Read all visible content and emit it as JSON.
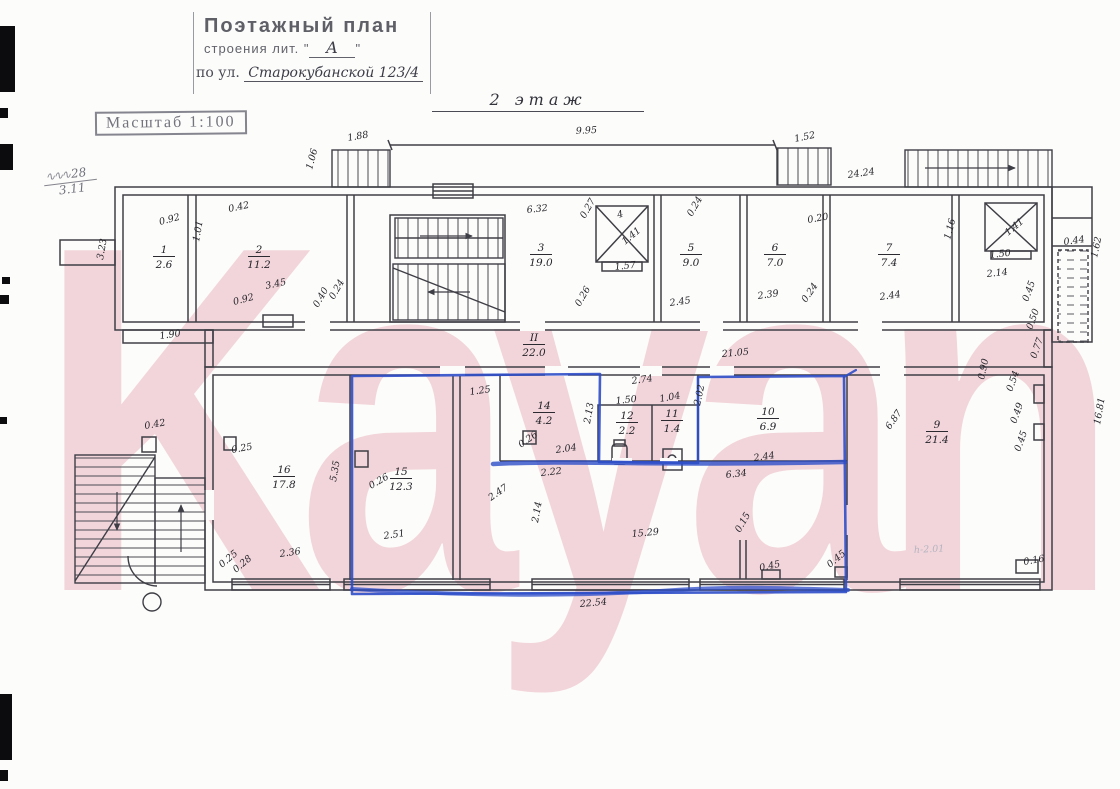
{
  "stamp": {
    "title": "Поэтажный план",
    "line2_prefix": "строения лит. \"",
    "lit": "А",
    "line2_suffix": "\"",
    "line3_prefix": "по ул.",
    "street": "Старокубанской 123/4"
  },
  "scale_stamp": "Масштаб 1:100",
  "floor_title": "2 этаж",
  "margin_note": {
    "top": "28",
    "bottom": "3.11"
  },
  "watermark": {
    "text": "Kayan",
    "color": "#eab6c0"
  },
  "highlight_color": "#2d4ec8",
  "plan": {
    "rooms": [
      {
        "n": "1",
        "a": "2.6",
        "x": 163,
        "y": 253
      },
      {
        "n": "2",
        "a": "11.2",
        "x": 258,
        "y": 253
      },
      {
        "n": "3",
        "a": "19.0",
        "x": 540,
        "y": 251
      },
      {
        "n": "5",
        "a": "9.0",
        "x": 690,
        "y": 251
      },
      {
        "n": "6",
        "a": "7.0",
        "x": 774,
        "y": 251
      },
      {
        "n": "7",
        "a": "7.4",
        "x": 888,
        "y": 251
      },
      {
        "n": "II",
        "a": "22.0",
        "x": 533,
        "y": 341
      },
      {
        "n": "14",
        "a": "4.2",
        "x": 543,
        "y": 409
      },
      {
        "n": "12",
        "a": "2.2",
        "x": 626,
        "y": 419
      },
      {
        "n": "11",
        "a": "1.4",
        "x": 671,
        "y": 417
      },
      {
        "n": "10",
        "a": "6.9",
        "x": 767,
        "y": 415
      },
      {
        "n": "9",
        "a": "21.4",
        "x": 936,
        "y": 428
      },
      {
        "n": "16",
        "a": "17.8",
        "x": 283,
        "y": 473
      },
      {
        "n": "15",
        "a": "12.3",
        "x": 400,
        "y": 475
      }
    ],
    "dim_labels": [
      {
        "t": "1.88",
        "x": 348,
        "y": 141,
        "r": -10
      },
      {
        "t": "9.95",
        "x": 576,
        "y": 134,
        "r": -3
      },
      {
        "t": "1.52",
        "x": 795,
        "y": 142,
        "r": -12
      },
      {
        "t": "1.06",
        "x": 312,
        "y": 170,
        "r": -75
      },
      {
        "t": "24.24",
        "x": 848,
        "y": 178,
        "r": -8
      },
      {
        "t": "3.23",
        "x": 103,
        "y": 260,
        "r": -80
      },
      {
        "t": "1.90",
        "x": 160,
        "y": 339,
        "r": -8
      },
      {
        "t": "0.92",
        "x": 160,
        "y": 225,
        "r": -15
      },
      {
        "t": "1.01",
        "x": 199,
        "y": 242,
        "r": -80
      },
      {
        "t": "0.42",
        "x": 229,
        "y": 212,
        "r": -12
      },
      {
        "t": "0.92",
        "x": 234,
        "y": 305,
        "r": -15
      },
      {
        "t": "3.45",
        "x": 266,
        "y": 289,
        "r": -12
      },
      {
        "t": "0.40",
        "x": 318,
        "y": 308,
        "r": -60
      },
      {
        "t": "0.24",
        "x": 334,
        "y": 300,
        "r": -60
      },
      {
        "t": "6.32",
        "x": 527,
        "y": 213,
        "r": -6
      },
      {
        "t": "0.27",
        "x": 585,
        "y": 219,
        "r": -60
      },
      {
        "t": "0.26",
        "x": 580,
        "y": 307,
        "r": -60
      },
      {
        "t": "4",
        "x": 618,
        "y": 218,
        "r": -15
      },
      {
        "t": "1.41",
        "x": 625,
        "y": 245,
        "r": -40
      },
      {
        "t": "1.57",
        "x": 615,
        "y": 270,
        "r": -6
      },
      {
        "t": "0.24",
        "x": 692,
        "y": 217,
        "r": -60
      },
      {
        "t": "2.45",
        "x": 670,
        "y": 306,
        "r": -8
      },
      {
        "t": "0.20",
        "x": 808,
        "y": 223,
        "r": -10
      },
      {
        "t": "2.39",
        "x": 758,
        "y": 299,
        "r": -8
      },
      {
        "t": "0.24",
        "x": 806,
        "y": 303,
        "r": -55
      },
      {
        "t": "2.44",
        "x": 880,
        "y": 300,
        "r": -8
      },
      {
        "t": "1.16",
        "x": 950,
        "y": 240,
        "r": -75
      },
      {
        "t": "1.41",
        "x": 1008,
        "y": 236,
        "r": -40
      },
      {
        "t": "1.50",
        "x": 990,
        "y": 258,
        "r": -6
      },
      {
        "t": "2.14",
        "x": 987,
        "y": 277,
        "r": -6
      },
      {
        "t": "0.44",
        "x": 1064,
        "y": 245,
        "r": -8
      },
      {
        "t": "1.62",
        "x": 1097,
        "y": 258,
        "r": -78
      },
      {
        "t": "21.05",
        "x": 722,
        "y": 357,
        "r": -5
      },
      {
        "t": "2.74",
        "x": 632,
        "y": 384,
        "r": -8
      },
      {
        "t": "1.25",
        "x": 470,
        "y": 395,
        "r": -8
      },
      {
        "t": "1.50",
        "x": 616,
        "y": 404,
        "r": -6
      },
      {
        "t": "1.04",
        "x": 660,
        "y": 402,
        "r": -10
      },
      {
        "t": "2.13",
        "x": 590,
        "y": 424,
        "r": -80
      },
      {
        "t": "2.02",
        "x": 700,
        "y": 406,
        "r": -78
      },
      {
        "t": "2.04",
        "x": 556,
        "y": 453,
        "r": -8
      },
      {
        "t": "0.26",
        "x": 521,
        "y": 448,
        "r": -35
      },
      {
        "t": "2.22",
        "x": 541,
        "y": 476,
        "r": -6
      },
      {
        "t": "2.44",
        "x": 754,
        "y": 461,
        "r": -8
      },
      {
        "t": "6.34",
        "x": 726,
        "y": 478,
        "r": -6
      },
      {
        "t": "0.90",
        "x": 984,
        "y": 380,
        "r": -78
      },
      {
        "t": "6.87",
        "x": 890,
        "y": 430,
        "r": -55
      },
      {
        "t": "0.45",
        "x": 1028,
        "y": 302,
        "r": -70
      },
      {
        "t": "0.50",
        "x": 1032,
        "y": 330,
        "r": -70
      },
      {
        "t": "0.77",
        "x": 1036,
        "y": 359,
        "r": -70
      },
      {
        "t": "0.54",
        "x": 1012,
        "y": 392,
        "r": -70
      },
      {
        "t": "0.49",
        "x": 1016,
        "y": 424,
        "r": -70
      },
      {
        "t": "0.45",
        "x": 1020,
        "y": 452,
        "r": -70
      },
      {
        "t": "16.81",
        "x": 1100,
        "y": 425,
        "r": -80
      },
      {
        "t": "0.42",
        "x": 145,
        "y": 429,
        "r": -10
      },
      {
        "t": "0.25",
        "x": 232,
        "y": 453,
        "r": -10
      },
      {
        "t": "2.36",
        "x": 280,
        "y": 557,
        "r": -8
      },
      {
        "t": "0.28",
        "x": 236,
        "y": 573,
        "r": -40
      },
      {
        "t": "0.25",
        "x": 222,
        "y": 568,
        "r": -40
      },
      {
        "t": "5.35",
        "x": 336,
        "y": 482,
        "r": -80
      },
      {
        "t": "0.26",
        "x": 371,
        "y": 489,
        "r": -30
      },
      {
        "t": "2.51",
        "x": 384,
        "y": 539,
        "r": -8
      },
      {
        "t": "2.47",
        "x": 491,
        "y": 501,
        "r": -35
      },
      {
        "t": "2.14",
        "x": 538,
        "y": 523,
        "r": -80
      },
      {
        "t": "15.29",
        "x": 632,
        "y": 537,
        "r": -5
      },
      {
        "t": "0.15",
        "x": 740,
        "y": 533,
        "r": -60
      },
      {
        "t": "0.45",
        "x": 760,
        "y": 571,
        "r": -12
      },
      {
        "t": "0.45",
        "x": 830,
        "y": 568,
        "r": -40
      },
      {
        "t": "0.16",
        "x": 1024,
        "y": 565,
        "r": -10
      },
      {
        "t": "22.54",
        "x": 580,
        "y": 607,
        "r": -5
      },
      {
        "t": "h-2.01",
        "x": 914,
        "y": 553,
        "r": -3,
        "f": true
      }
    ]
  }
}
